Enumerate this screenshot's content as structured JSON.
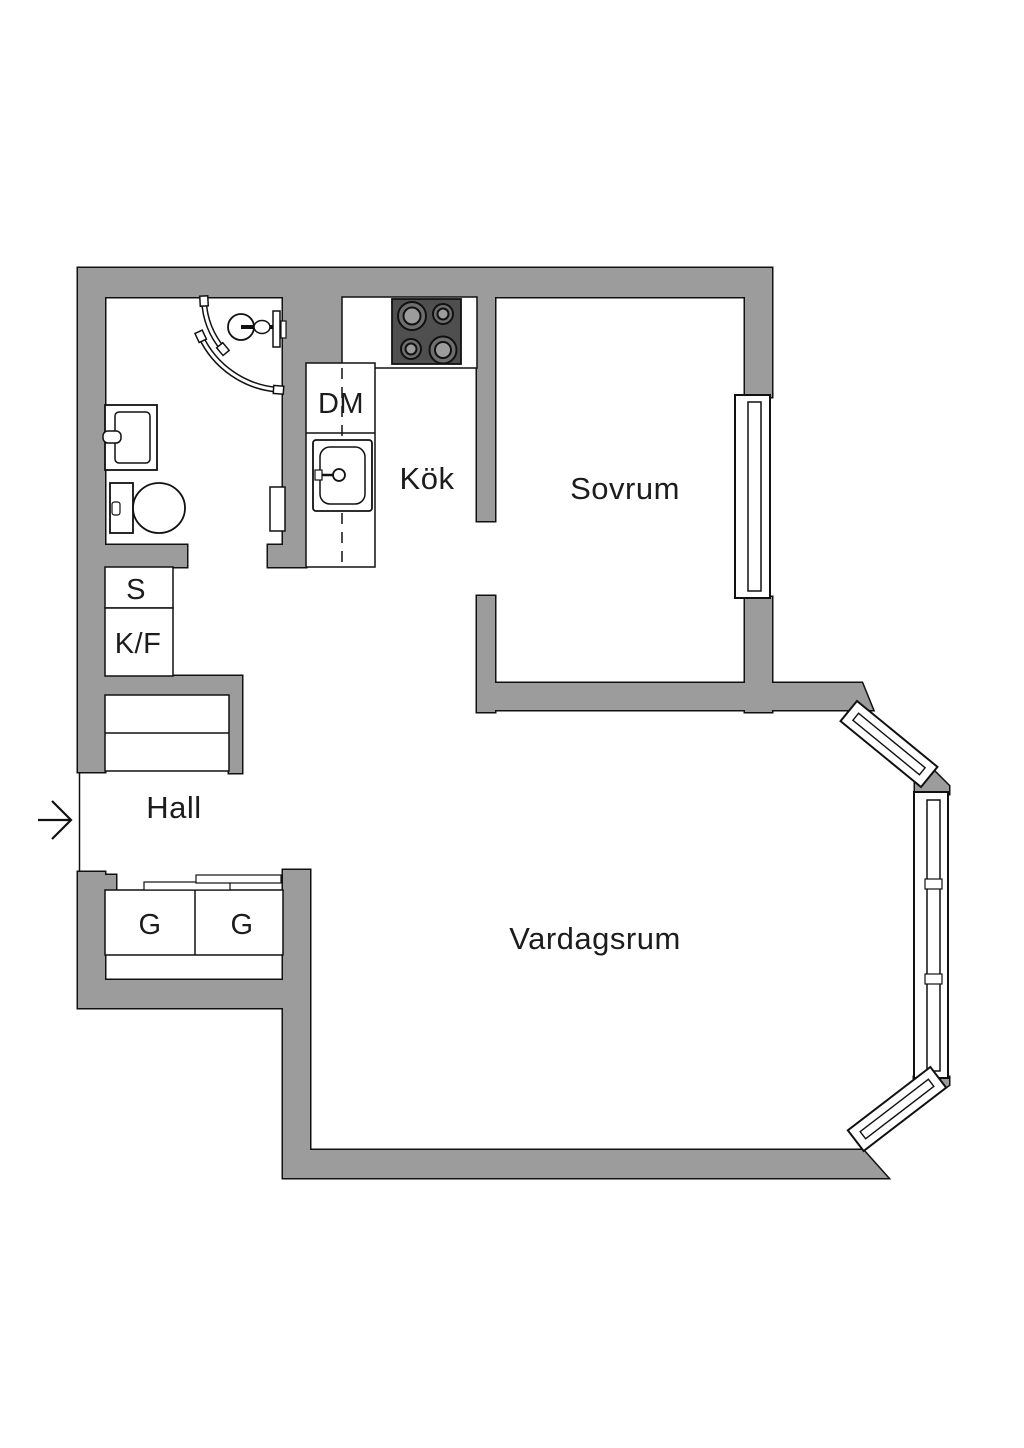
{
  "floorplan": {
    "rooms": {
      "kitchen": "Kök",
      "bedroom": "Sovrum",
      "hall": "Hall",
      "living_room": "Vardagsrum"
    },
    "labels": {
      "dishwasher": "DM",
      "cleaning_closet": "S",
      "fridge_freezer": "K/F",
      "wardrobe_1": "G",
      "wardrobe_2": "G"
    },
    "colors": {
      "wall_gray": "#9c9c9c",
      "stove_dark": "#4f4f4f",
      "outline": "#111111",
      "background": "#ffffff"
    }
  }
}
